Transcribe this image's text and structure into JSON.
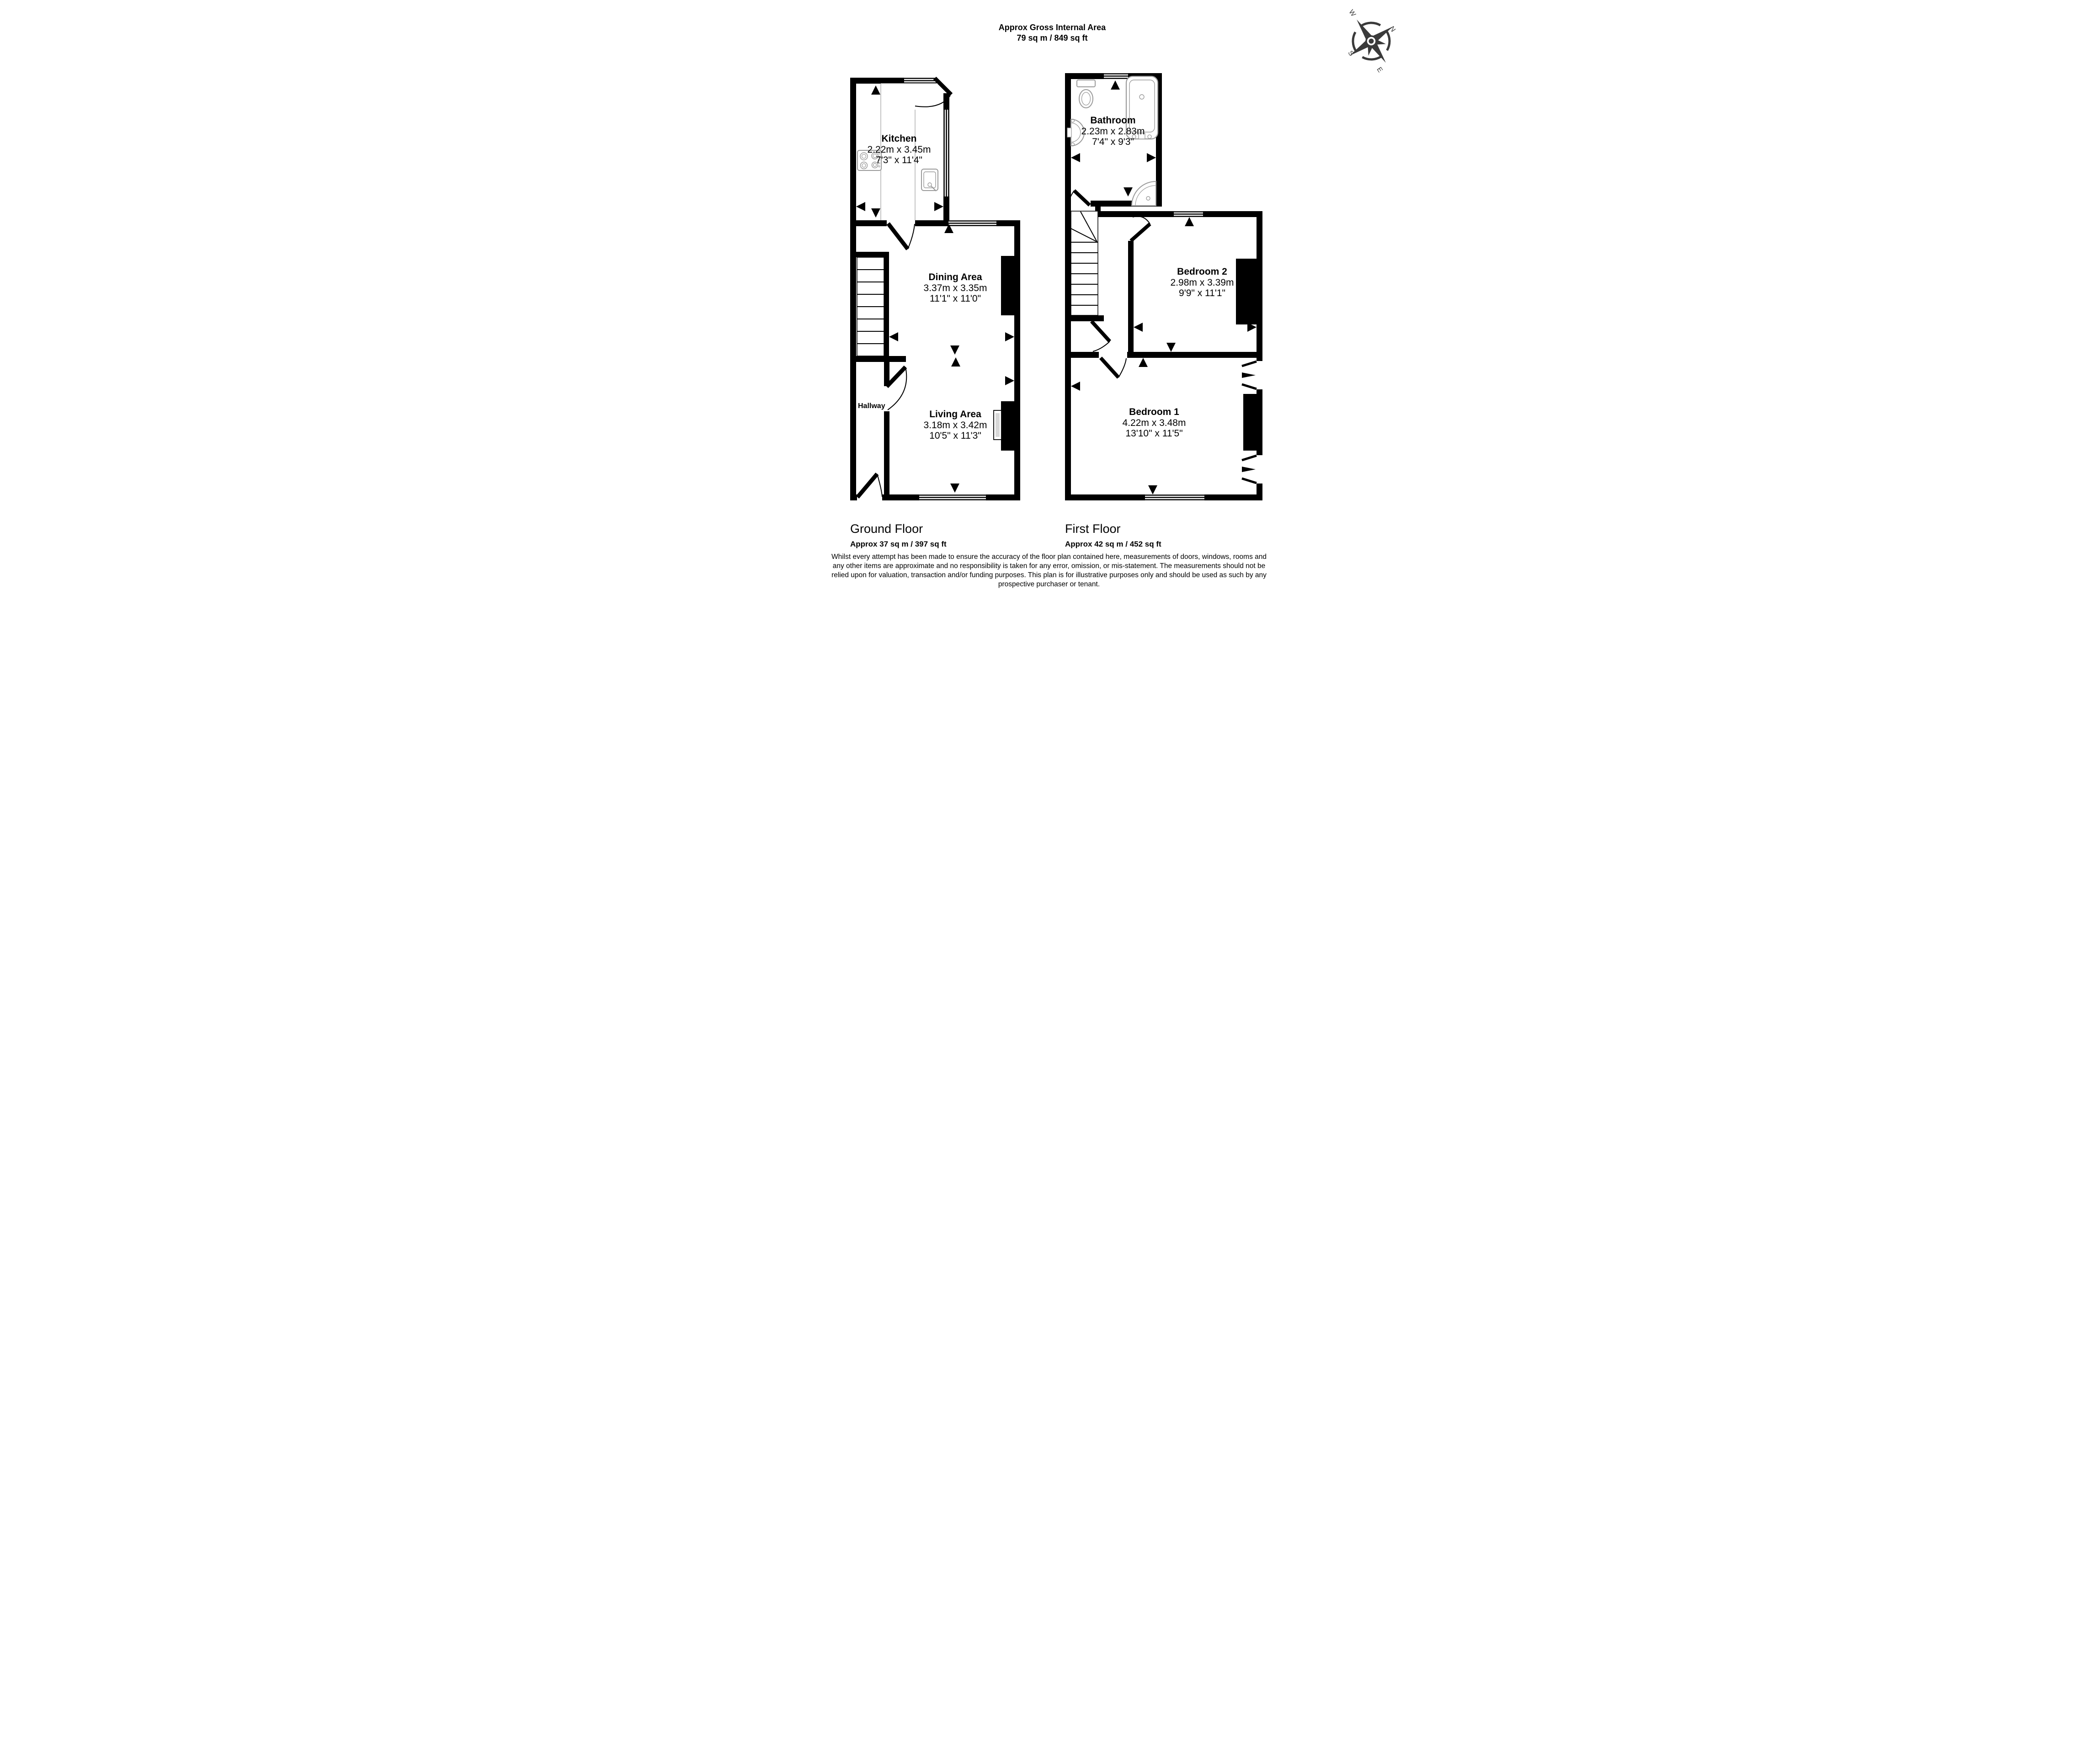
{
  "title": {
    "line1": "Approx Gross Internal Area",
    "line2": "79 sq m / 849 sq ft"
  },
  "compass": {
    "n": "N",
    "e": "E",
    "s": "S",
    "w": "W"
  },
  "floors": [
    {
      "name": "Ground Floor",
      "area": "Approx 37 sq m / 397 sq ft",
      "rooms": [
        {
          "name": "Kitchen",
          "metric": "2.22m x 3.45m",
          "imperial": "7'3\" x 11'4\""
        },
        {
          "name": "Dining Area",
          "metric": "3.37m x 3.35m",
          "imperial": "11'1\" x 11'0\""
        },
        {
          "name": "Hallway",
          "metric": "",
          "imperial": ""
        },
        {
          "name": "Living Area",
          "metric": "3.18m x 3.42m",
          "imperial": "10'5\" x 11'3\""
        }
      ]
    },
    {
      "name": "First Floor",
      "area": "Approx 42 sq m / 452 sq ft",
      "rooms": [
        {
          "name": "Bathroom",
          "metric": "2.23m x 2.83m",
          "imperial": "7'4\" x 9'3\""
        },
        {
          "name": "Bedroom 2",
          "metric": "2.98m x 3.39m",
          "imperial": "9'9\" x 11'1\""
        },
        {
          "name": "Bedroom 1",
          "metric": "4.22m x 3.48m",
          "imperial": "13'10\" x 11'5\""
        }
      ]
    }
  ],
  "disclaimer": {
    "lines": [
      "Whilst every attempt has been made to ensure the accuracy of the floor plan contained here, measurements of doors, windows, rooms and",
      "any other items are approximate and no responsibility is taken for any error, omission, or mis-statement. The measurements should not be",
      "relied upon for valuation, transaction and/or funding purposes. This plan is for illustrative purposes only and should be used as such by any",
      "prospective purchaser or tenant."
    ]
  }
}
